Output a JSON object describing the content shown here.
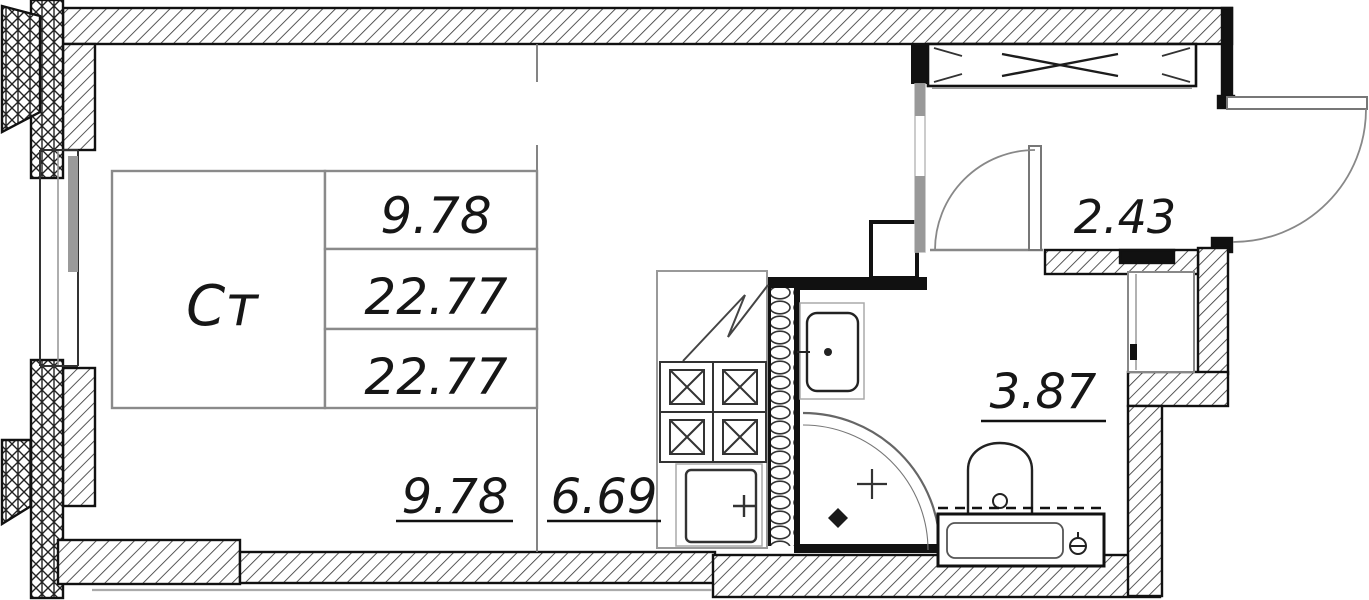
{
  "plan": {
    "unit": {
      "type_label": "Ст",
      "area_rows": [
        "9.78",
        "22.77",
        "22.77"
      ]
    },
    "zone_areas": {
      "living": "9.78",
      "kitchen": "6.69"
    },
    "hall": {
      "area": "2.43"
    },
    "bathroom": {
      "area": "3.87"
    },
    "fixtures": [
      "stove-4-burner-icon",
      "kitchen-sink-icon",
      "washbasin-icon",
      "corner-shower-icon",
      "toilet-icon",
      "bathtub-icon",
      "wardrobe-vent-icon",
      "entrance-door-swing",
      "bathroom-door-swing"
    ],
    "colors": {
      "ink": "#161616",
      "wall_hatch": "#3a3a3a",
      "muted_line": "#8a8a8a",
      "light_line": "#b5b5b5"
    }
  }
}
